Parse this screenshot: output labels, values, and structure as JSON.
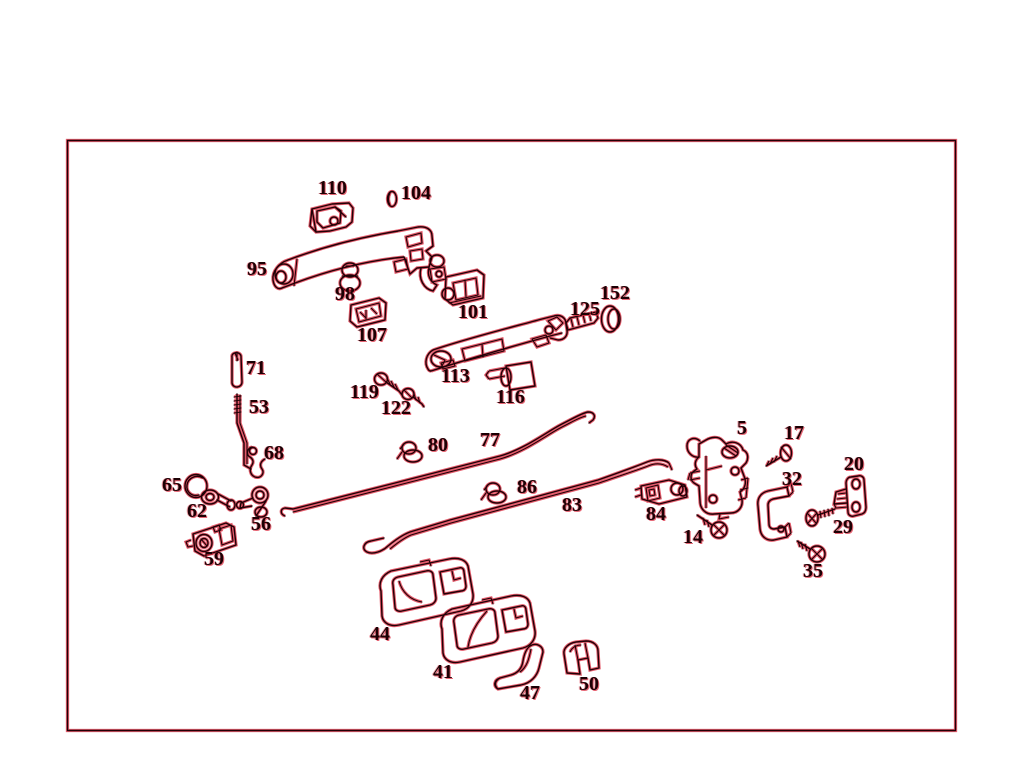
{
  "colors": {
    "background": "#ffffff",
    "ink": "#200006",
    "fringe_red": "#dd3347"
  },
  "diagram": {
    "type": "exploded-parts-diagram",
    "labels": [
      {
        "text": "110",
        "x": 318,
        "y": 182
      },
      {
        "text": "104",
        "x": 401,
        "y": 187
      },
      {
        "text": "95",
        "x": 247,
        "y": 263
      },
      {
        "text": "98",
        "x": 335,
        "y": 288
      },
      {
        "text": "101",
        "x": 458,
        "y": 306
      },
      {
        "text": "107",
        "x": 357,
        "y": 329
      },
      {
        "text": "152",
        "x": 600,
        "y": 287
      },
      {
        "text": "125",
        "x": 570,
        "y": 303
      },
      {
        "text": "113",
        "x": 441,
        "y": 370
      },
      {
        "text": "119",
        "x": 350,
        "y": 386
      },
      {
        "text": "122",
        "x": 381,
        "y": 402
      },
      {
        "text": "116",
        "x": 496,
        "y": 391
      },
      {
        "text": "71",
        "x": 246,
        "y": 362
      },
      {
        "text": "53",
        "x": 249,
        "y": 401
      },
      {
        "text": "68",
        "x": 264,
        "y": 447
      },
      {
        "text": "80",
        "x": 428,
        "y": 439
      },
      {
        "text": "77",
        "x": 480,
        "y": 434
      },
      {
        "text": "65",
        "x": 162,
        "y": 479
      },
      {
        "text": "62",
        "x": 187,
        "y": 505
      },
      {
        "text": "56",
        "x": 251,
        "y": 518
      },
      {
        "text": "86",
        "x": 517,
        "y": 481
      },
      {
        "text": "83",
        "x": 562,
        "y": 499
      },
      {
        "text": "59",
        "x": 204,
        "y": 553
      },
      {
        "text": "5",
        "x": 737,
        "y": 422
      },
      {
        "text": "17",
        "x": 784,
        "y": 427
      },
      {
        "text": "20",
        "x": 844,
        "y": 458
      },
      {
        "text": "32",
        "x": 782,
        "y": 473
      },
      {
        "text": "84",
        "x": 646,
        "y": 508
      },
      {
        "text": "14",
        "x": 683,
        "y": 531
      },
      {
        "text": "29",
        "x": 833,
        "y": 521
      },
      {
        "text": "35",
        "x": 803,
        "y": 565
      },
      {
        "text": "44",
        "x": 370,
        "y": 628
      },
      {
        "text": "41",
        "x": 433,
        "y": 666
      },
      {
        "text": "47",
        "x": 520,
        "y": 687
      },
      {
        "text": "50",
        "x": 579,
        "y": 678
      }
    ]
  }
}
